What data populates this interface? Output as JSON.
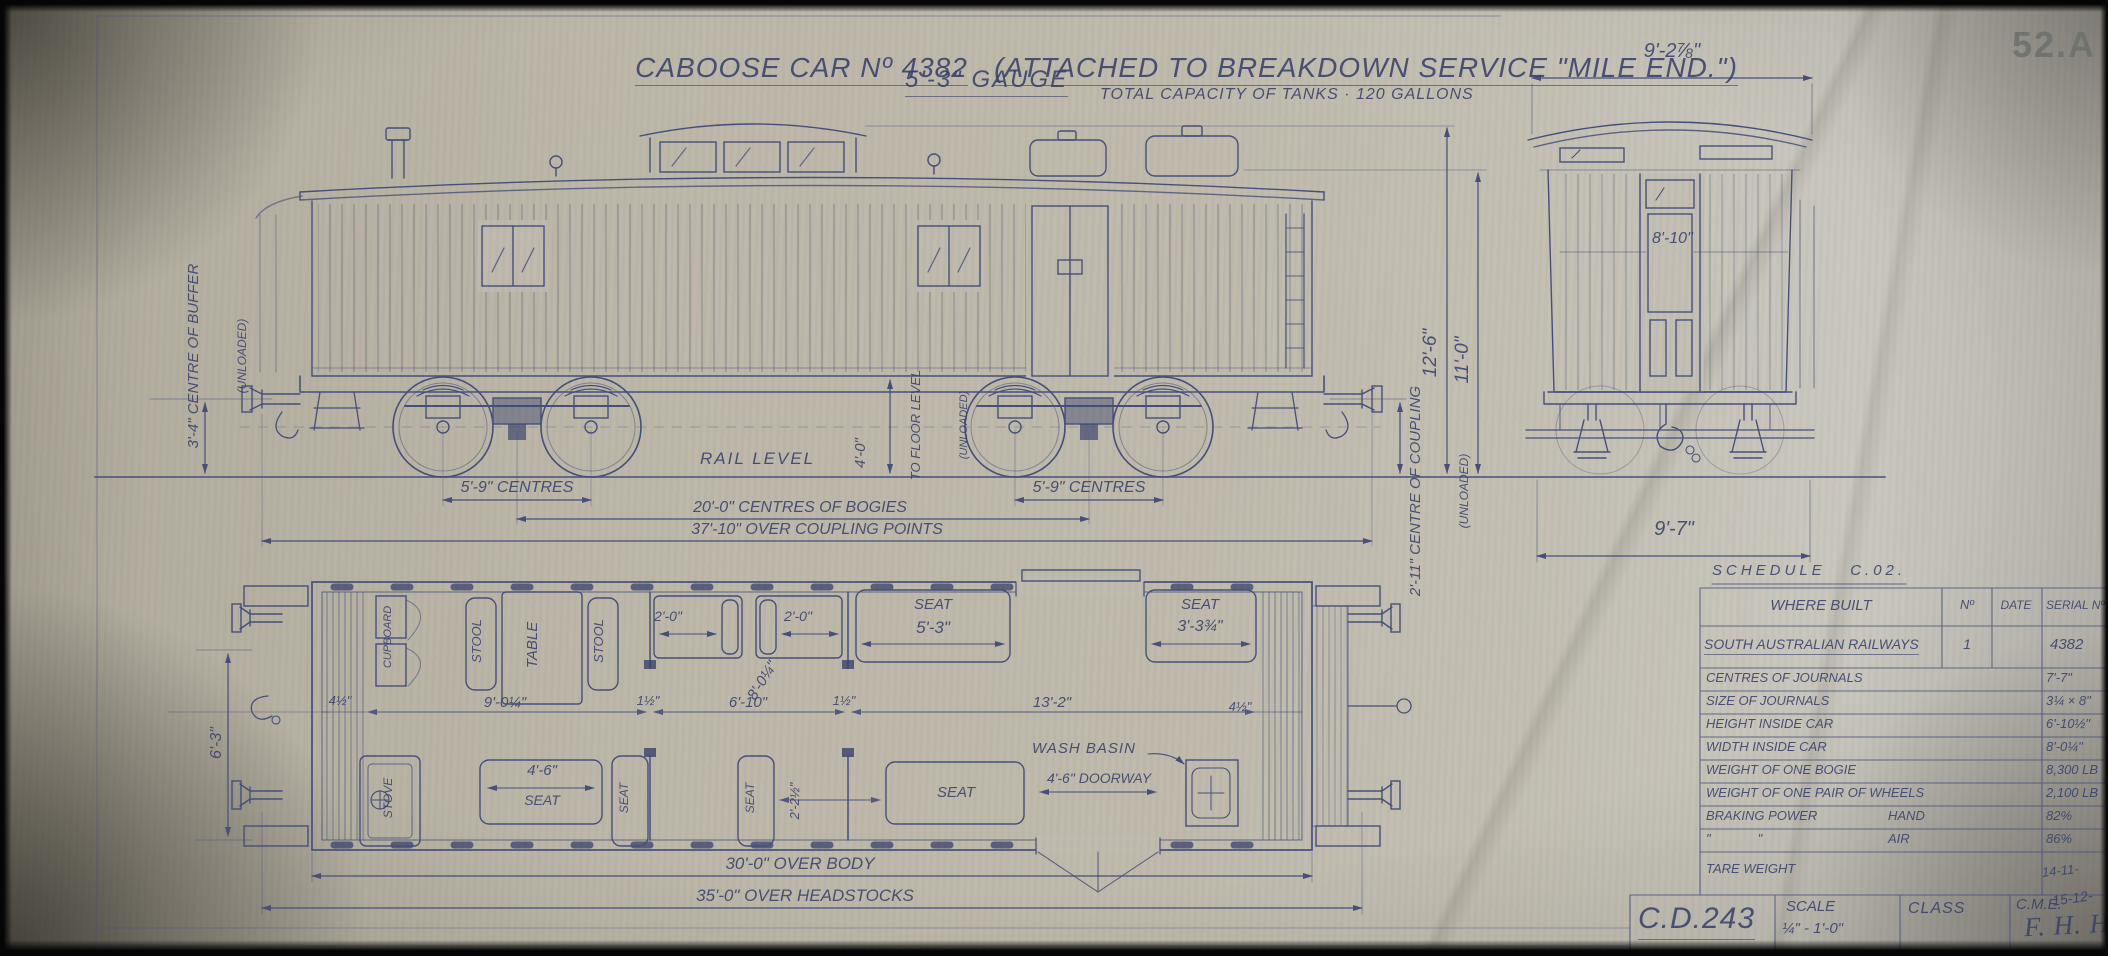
{
  "header": {
    "title": "CABOOSE CAR Nº 4382",
    "subtitle": "(ATTACHED TO BREAKDOWN SERVICE \"MILE END.\")",
    "gauge": "5'-3\" GAUGE",
    "sheet_no": "52.A"
  },
  "elevation": {
    "tanks_note": "TOTAL CAPACITY OF TANKS · 120 GALLONS",
    "buffer_centre": "3'-4\" CENTRE OF BUFFER",
    "buffer_centre_sub": "(UNLOADED)",
    "floor_dim": "4'-0\"",
    "floor_label": "TO FLOOR LEVEL",
    "floor_sub": "(UNLOADED)",
    "rail_level": "RAIL LEVEL",
    "coupling_centre": "2'-11\" CENTRE OF COUPLING",
    "coupling_sub": "(UNLOADED)",
    "height_overall": "12'-6\"",
    "height_roof": "11'-0\"",
    "bogie_centres_left": "5'-9\" CENTRES",
    "bogie_centres_right": "5'-9\" CENTRES",
    "bogie_spacing": "20'-0\" CENTRES OF BOGIES",
    "coupling_points": "37'-10\" OVER COUPLING POINTS"
  },
  "end_view": {
    "width_top": "9'-2⅞\"",
    "width_inside": "8'-10\"",
    "width_bottom": "9'-7\""
  },
  "plan": {
    "cupboard": "CUPBOARD",
    "stool1": "STOOL",
    "table": "TABLE",
    "stool2": "STOOL",
    "locker1_dim": "2'-0\"",
    "locker2_dim": "2'-0\"",
    "seat1_label": "SEAT",
    "seat1_dim": "5'-3\"",
    "seat2_label": "SEAT",
    "seat2_dim": "3'-3¾\"",
    "dim_wall_left": "4½\"",
    "dim_room1": "9'-0¼\"",
    "dim_wall1": "1½\"",
    "dim_room2": "6'-10\"",
    "dim_wall2": "1½\"",
    "dim_room3": "13'-2\"",
    "dim_wall_right": "4½\"",
    "dim_inside_width": "8'-0¼\"",
    "stove": "STOVE",
    "seat3_dim": "4'-6\"",
    "seat3_label": "SEAT",
    "seat4": "SEAT",
    "seat5": "SEAT",
    "dim_seat_gap": "2'-2½\"",
    "seat6": "SEAT",
    "wash_basin": "WASH BASIN",
    "doorway_dim": "4'-6\" DOORWAY",
    "dim_height": "6'-3\"",
    "over_body": "30'-0\" OVER BODY",
    "over_headstocks": "35'-0\" OVER HEADSTOCKS"
  },
  "schedule": {
    "heading": "SCHEDULE   C.02.",
    "columns": {
      "where_built": "WHERE BUILT",
      "no": "Nº",
      "date": "DATE",
      "serial": "SERIAL Nº"
    },
    "builder": {
      "name": "SOUTH AUSTRALIAN RAILWAYS",
      "no": "1",
      "date": "",
      "serial": "4382"
    },
    "rows": [
      {
        "label": "CENTRES OF JOURNALS",
        "sub": "",
        "value": "7'-7\""
      },
      {
        "label": "SIZE OF JOURNALS",
        "sub": "",
        "value": "3¼ × 8\""
      },
      {
        "label": "HEIGHT INSIDE CAR",
        "sub": "",
        "value": "6'-10½\""
      },
      {
        "label": "WIDTH INSIDE CAR",
        "sub": "",
        "value": "8'-0¼\""
      },
      {
        "label": "WEIGHT OF ONE BOGIE",
        "sub": "",
        "value": "8,300 LB"
      },
      {
        "label": "WEIGHT OF ONE PAIR OF WHEELS",
        "sub": "",
        "value": "2,100 LB"
      },
      {
        "label": "BRAKING POWER",
        "sub": "HAND",
        "value": "82%"
      },
      {
        "label": "\"             \"",
        "sub": "AIR",
        "value": "86%"
      },
      {
        "label": "TARE WEIGHT",
        "sub": "",
        "value": "14-11-"
      }
    ]
  },
  "title_block": {
    "drawing_no": "C.D.243",
    "scale_label": "SCALE",
    "scale_value": "¼\" - 1'-0\"",
    "class_label": "CLASS",
    "cme_label": "C.M.E.",
    "signature": "F. H. Hamson",
    "date": "15-12-"
  }
}
